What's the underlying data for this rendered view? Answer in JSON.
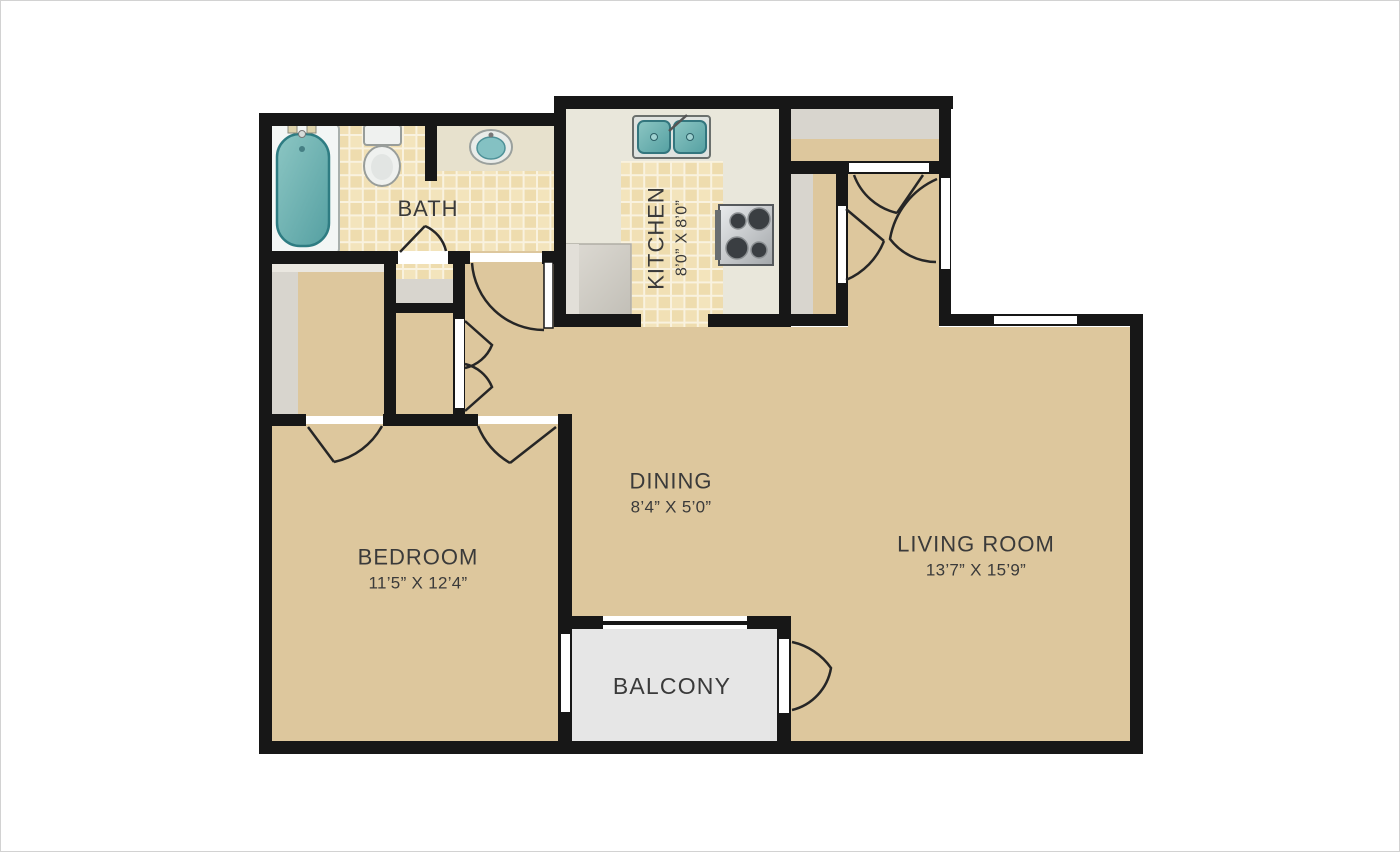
{
  "title": "Apartment floor plan",
  "rooms": {
    "bath": {
      "name": "BATH"
    },
    "kitchen": {
      "name": "KITCHEN",
      "dims": "8’0” X 8’0”"
    },
    "dining": {
      "name": "DINING",
      "dims": "8’4” X 5’0”"
    },
    "living_room": {
      "name": "LIVING ROOM",
      "dims": "13’7” X 15’9”"
    },
    "bedroom": {
      "name": "BEDROOM",
      "dims": "11’5” X 12’4”"
    },
    "balcony": {
      "name": "BALCONY"
    }
  },
  "icons": {
    "bathtub": "bathtub-icon",
    "toilet": "toilet-icon",
    "bathroom_sink": "sink-icon",
    "kitchen_sink": "double-sink-icon",
    "stove": "stove-icon",
    "refrigerator": "refrigerator-icon"
  },
  "colors": {
    "wall": "#171717",
    "door_line": "#262626",
    "white_opening": "#ffffff",
    "floor_tan": "#ddc79d",
    "tile": "#eedcae",
    "tile_light": "#f3e4bc",
    "grout": "#f9f2df",
    "kitchen_floor": "#e9e7db",
    "counter": "#e7e1cd",
    "closet_gray": "#d8d5ce",
    "closet_shelf": "#eae7e0",
    "balcony_gray": "#e6e6e6",
    "fixture_teal": "#6fb7b6",
    "fixture_teal_dark": "#2e7c82",
    "fixture_white": "#eff1ef",
    "fixture_stroke": "#989d9a",
    "appliance_gray": "#ccc9c1",
    "label_text": "#3a3a3a",
    "page_border": "#d2d2d2"
  }
}
